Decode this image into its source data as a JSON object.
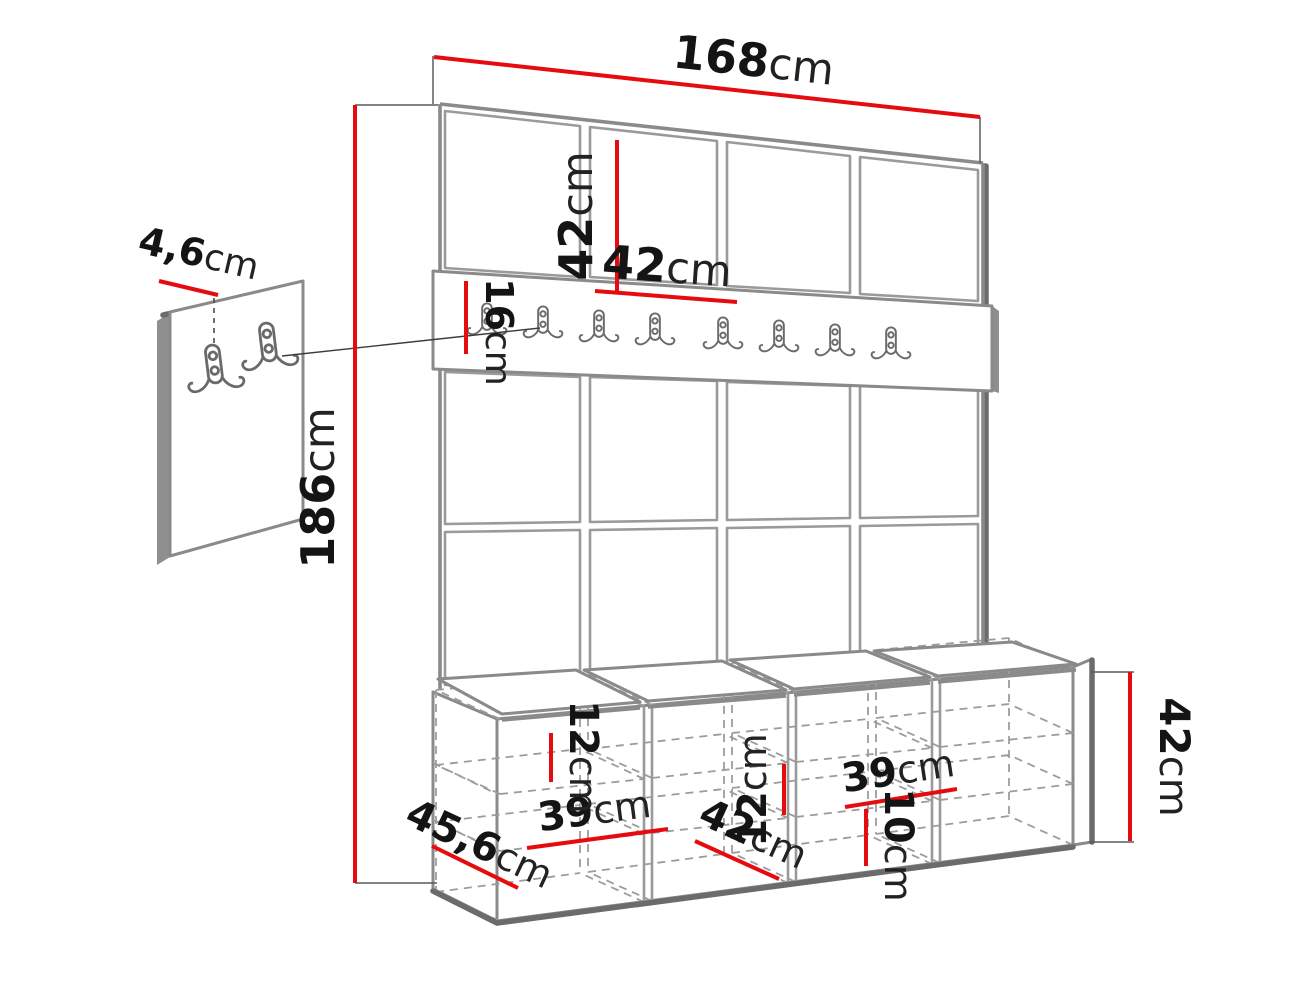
{
  "diagram": {
    "colors": {
      "dimension_red": "#e60b0e",
      "line_gray": "#8a8a8a",
      "dark_gray": "#6b6b6b",
      "text_black": "#141414",
      "background": "#ffffff"
    },
    "counts": {
      "panel_columns": 4,
      "panel_tile_rows": 3,
      "rail_hooks": 8,
      "wall_hook_panel_hooks": 2,
      "bench_compartments": 4,
      "seat_cushions": 4
    },
    "icons": {
      "rail_hook": "double-coat-hook",
      "panel_hook": "double-coat-hook"
    },
    "dimensions": {
      "total_width": {
        "value": "168",
        "unit": "cm"
      },
      "panel_tile_height": {
        "value": "42",
        "unit": "cm"
      },
      "panel_tile_width": {
        "value": "42",
        "unit": "cm"
      },
      "hook_rail_height": {
        "value": "16",
        "unit": "cm"
      },
      "total_height": {
        "value": "186",
        "unit": "cm"
      },
      "hook_panel_depth": {
        "value": "4,6",
        "unit": "cm"
      },
      "bench_depth": {
        "value": "45,6",
        "unit": "cm"
      },
      "bench_compartment_width_left": {
        "value": "39",
        "unit": "cm"
      },
      "bench_shelf_gap_left": {
        "value": "12",
        "unit": "cm"
      },
      "bench_compartment_depth": {
        "value": "42",
        "unit": "cm"
      },
      "bench_shelf_gap_mid": {
        "value": "12",
        "unit": "cm"
      },
      "bench_compartment_width_right": {
        "value": "39",
        "unit": "cm"
      },
      "bench_plinth_height": {
        "value": "10",
        "unit": "cm"
      },
      "bench_height": {
        "value": "42",
        "unit": "cm"
      }
    }
  }
}
